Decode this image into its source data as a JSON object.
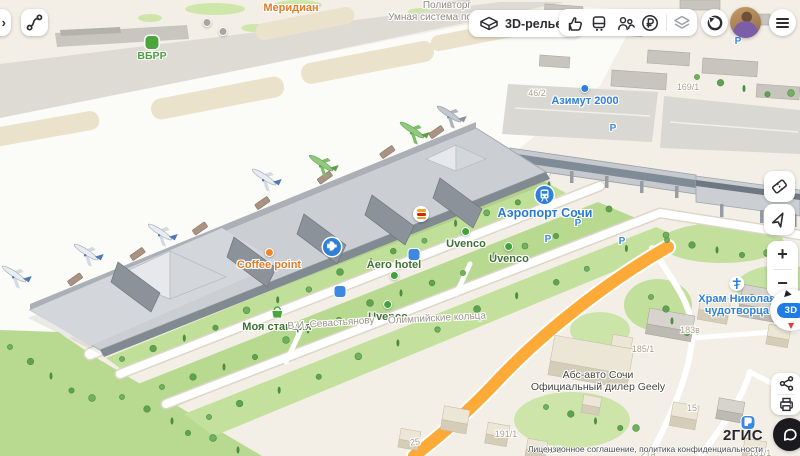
{
  "topbar": {
    "panel_chevron": "›",
    "relief_label": "3D-рельеф"
  },
  "controls": {
    "zoom_in": "+",
    "zoom_out": "−",
    "mode_badge": "3D"
  },
  "footer": {
    "logo": "2ГИС",
    "license": "Лицензионное соглашение, политика конфиденциальности"
  },
  "icons": {
    "directions": "route-squiggle",
    "relief": "3d-terrain-box",
    "taxi": "thumb-up-hand",
    "transport": "bus",
    "friends": "two-people",
    "payments": "ruble-circle",
    "layers": "stacked-layers",
    "compass": "compass-ring",
    "menu": "hamburger",
    "tickets": "ticket",
    "locate": "navigation-arrow",
    "share": "share-nodes",
    "print": "printer",
    "chat": "speech-bubble"
  },
  "palette": {
    "accent_blue": "#2f80d8",
    "poi_green": "#3f7034",
    "poi_orange": "#e07b28",
    "orange_road": "#fdaa38",
    "grass": "#b7da90",
    "chat_black": "#1b1b1f"
  },
  "map": {
    "labels": [
      {
        "lines": [
          "Меридиан"
        ],
        "cls": "poi-orange",
        "x": 291,
        "y": 2,
        "name": "label-meridian",
        "inter": true
      },
      {
        "lines": [
          "Поливторг"
        ],
        "cls": "bldg",
        "x": 447,
        "y": 0,
        "name": "label-polivtorg",
        "inter": false
      },
      {
        "lines": [
          "Умная система по"
        ],
        "cls": "bldg",
        "x": 430,
        "y": 12,
        "name": "label-umnaya-sistema",
        "inter": false
      },
      {
        "lines": [
          "ВБРР"
        ],
        "cls": "poi-bright-green",
        "x": 152,
        "y": 36,
        "icon": "bank",
        "name": "label-vbrr",
        "inter": true
      },
      {
        "lines": [
          "Азимут 2000"
        ],
        "cls": "poi-blue",
        "x": 585,
        "y": 84,
        "icon": "bluedot",
        "name": "label-azimut-2000",
        "inter": true
      },
      {
        "lines": [
          "169/1"
        ],
        "cls": "hnum",
        "x": 688,
        "y": 82,
        "inter": false
      },
      {
        "lines": [
          "46/2"
        ],
        "cls": "hnum",
        "x": 537,
        "y": 88,
        "inter": false
      },
      {
        "lines": [
          "Аэропорт Сочи"
        ],
        "cls": "poi-blue-lg",
        "x": 545,
        "y": 186,
        "icon": "train",
        "name": "label-airport-sochi",
        "inter": true
      },
      {
        "lines": [
          "Coffee point"
        ],
        "cls": "poi-orange",
        "x": 269,
        "y": 248,
        "icon": "orangedot",
        "name": "label-coffee-point",
        "inter": true
      },
      {
        "lines": [
          "Uvenco"
        ],
        "cls": "poi-green",
        "x": 466,
        "y": 227,
        "icon": "greendot",
        "name": "label-uvenco-1",
        "inter": true
      },
      {
        "lines": [
          "Uvenco"
        ],
        "cls": "poi-green",
        "x": 509,
        "y": 242,
        "icon": "greendot",
        "name": "label-uvenco-2",
        "inter": true
      },
      {
        "lines": [
          "Uvenco"
        ],
        "cls": "poi-green",
        "x": 388,
        "y": 300,
        "icon": "greendot",
        "name": "label-uvenco-3",
        "inter": true
      },
      {
        "lines": [
          "Aero hotel"
        ],
        "cls": "poi-green",
        "x": 394,
        "y": 259,
        "icon": "greendot",
        "ip": "below",
        "name": "label-aero-hotel",
        "inter": true
      },
      {
        "lines": [
          "Моя станция"
        ],
        "cls": "poi-green",
        "x": 277,
        "y": 306,
        "icon": "basket",
        "name": "label-moya-stantsia",
        "inter": true
      },
      {
        "lines": [
          "В.И. Севастьянову"
        ],
        "cls": "street",
        "x": 331,
        "y": 318,
        "rot": -4,
        "name": "label-street-sevastyanovu",
        "inter": false
      },
      {
        "lines": [
          "Олимпийские кольца"
        ],
        "cls": "street",
        "x": 437,
        "y": 313,
        "rot": -3,
        "name": "label-street-olimpiyskie",
        "inter": false
      },
      {
        "lines": [
          "Храм Николая",
          "чудотворца"
        ],
        "cls": "poi-blue",
        "x": 737,
        "y": 276,
        "icon": "cross",
        "name": "label-hram-nikolaya",
        "inter": true
      },
      {
        "lines": [
          "Абс-авто Сочи",
          "Официальный дилер Geely"
        ],
        "cls": "dealer",
        "x": 598,
        "y": 368,
        "icon": "dealerc",
        "name": "label-abs-auto-geely",
        "inter": true
      },
      {
        "lines": [
          "183в"
        ],
        "cls": "hnum",
        "x": 690,
        "y": 325,
        "inter": false
      },
      {
        "lines": [
          "185/1"
        ],
        "cls": "hnum",
        "x": 643,
        "y": 344,
        "inter": false
      },
      {
        "lines": [
          "15"
        ],
        "cls": "hnum",
        "x": 692,
        "y": 403,
        "inter": false
      },
      {
        "lines": [
          "15а"
        ],
        "cls": "hnum",
        "x": 789,
        "y": 418,
        "inter": false
      },
      {
        "lines": [
          "191/1"
        ],
        "cls": "hnum",
        "x": 506,
        "y": 429,
        "inter": false
      },
      {
        "lines": [
          "21/2"
        ],
        "cls": "hnum",
        "x": 553,
        "y": 445,
        "inter": false
      },
      {
        "lines": [
          "21а"
        ],
        "cls": "hnum",
        "x": 648,
        "y": 449,
        "inter": false
      },
      {
        "lines": [
          "25"
        ],
        "cls": "hnum",
        "x": 415,
        "y": 437,
        "rot": -8,
        "inter": false
      },
      {
        "lines": [
          "181/1"
        ],
        "cls": "hnum",
        "x": 760,
        "y": 448,
        "inter": false
      },
      {
        "lines": [],
        "cls": "badge",
        "x": 332,
        "y": 238,
        "icon": "planebadge",
        "name": "airport-marker",
        "inter": true
      },
      {
        "lines": [],
        "cls": "badge",
        "x": 421,
        "y": 206,
        "icon": "bk",
        "name": "burger-king-marker",
        "inter": true
      },
      {
        "lines": [],
        "cls": "badge",
        "x": 340,
        "y": 286,
        "icon": "busstop",
        "name": "bus-stop-marker",
        "inter": true
      },
      {
        "lines": [],
        "cls": "badge",
        "x": 414,
        "y": 249,
        "icon": "busstop",
        "name": "bus-stop-marker",
        "inter": true
      },
      {
        "lines": [],
        "cls": "badge",
        "x": 207,
        "y": 18,
        "icon": "graycircle",
        "name": "poi-dot",
        "inter": true
      },
      {
        "lines": [],
        "cls": "badge",
        "x": 223,
        "y": 27,
        "icon": "graycircle",
        "name": "poi-dot",
        "inter": true
      },
      {
        "lines": [
          "P"
        ],
        "cls": "pletter",
        "x": 578,
        "y": 218,
        "name": "parking-letter",
        "inter": true
      },
      {
        "lines": [
          "P"
        ],
        "cls": "pletter",
        "x": 548,
        "y": 234,
        "name": "parking-letter",
        "inter": true
      },
      {
        "lines": [
          "P"
        ],
        "cls": "pletter",
        "x": 622,
        "y": 236,
        "name": "parking-letter",
        "inter": true
      },
      {
        "lines": [
          "P"
        ],
        "cls": "pletter",
        "x": 613,
        "y": 123,
        "name": "parking-letter",
        "inter": true
      },
      {
        "lines": [
          "P"
        ],
        "cls": "pletter",
        "x": 738,
        "y": 36,
        "name": "parking-letter",
        "inter": true
      },
      {
        "lines": [],
        "cls": "badge",
        "x": 748,
        "y": 416,
        "icon": "pbadge",
        "name": "parking-badge",
        "inter": true
      }
    ],
    "planes": [
      {
        "x": 14,
        "y": 274,
        "c": "white"
      },
      {
        "x": 86,
        "y": 252,
        "c": "white"
      },
      {
        "x": 160,
        "y": 232,
        "c": "white"
      },
      {
        "x": 264,
        "y": 177,
        "c": "white"
      },
      {
        "x": 321,
        "y": 163,
        "c": "green"
      },
      {
        "x": 412,
        "y": 130,
        "c": "green"
      },
      {
        "x": 449,
        "y": 114,
        "c": "gray"
      }
    ]
  }
}
